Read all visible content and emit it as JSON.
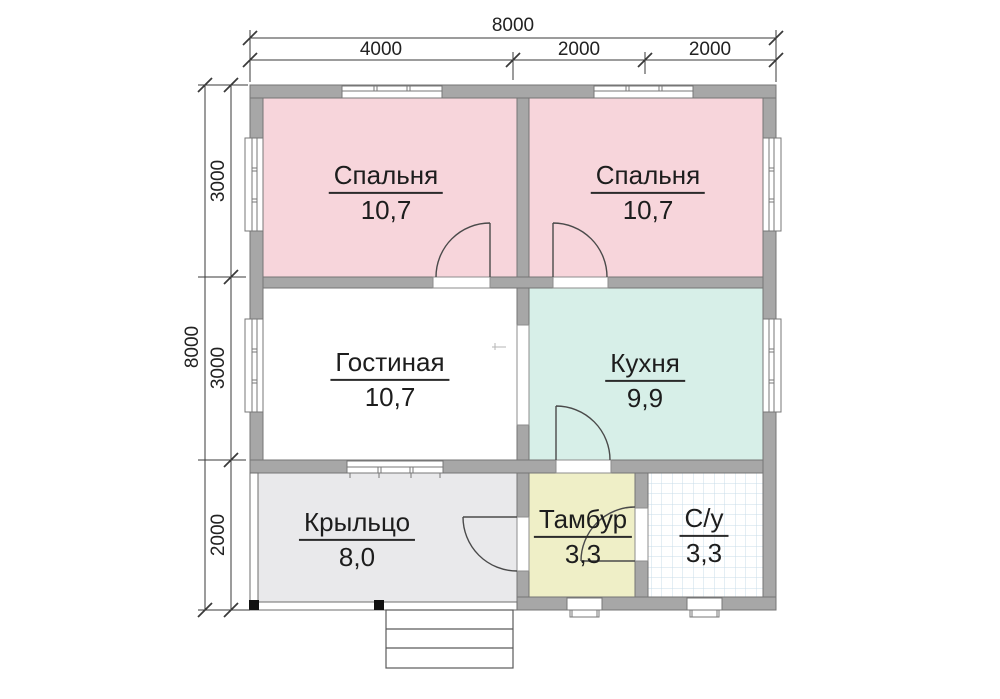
{
  "plan_title": "House floor plan 8000x8000",
  "rooms": [
    {
      "id": "bedroom-1",
      "name": "Спальня",
      "area": "10,7"
    },
    {
      "id": "bedroom-2",
      "name": "Спальня",
      "area": "10,7"
    },
    {
      "id": "living",
      "name": "Гостиная",
      "area": "10,7"
    },
    {
      "id": "kitchen",
      "name": "Кухня",
      "area": "9,9"
    },
    {
      "id": "porch",
      "name": "Крыльцо",
      "area": "8,0"
    },
    {
      "id": "vestibule",
      "name": "Тамбур",
      "area": "3,3"
    },
    {
      "id": "bathroom",
      "name": "С/у",
      "area": "3,3"
    }
  ],
  "dimensions": {
    "top": {
      "total": "8000",
      "segments": [
        "4000",
        "2000",
        "2000"
      ]
    },
    "left": {
      "total": "8000",
      "segments": [
        "3000",
        "3000",
        "2000"
      ]
    }
  },
  "colors": {
    "wall": "#a7a7a7",
    "wall_edge": "#757575",
    "bedroom": "#f7d5db",
    "kitchen": "#d7efe8",
    "vestibule": "#efefc7",
    "porch": "#e9e9eb",
    "living": "#ffffff",
    "bathroom": "#ffffff",
    "tile_line": "#c9dcea",
    "door_line": "#4a4a4a",
    "dim_line": "#3a3a3a"
  }
}
